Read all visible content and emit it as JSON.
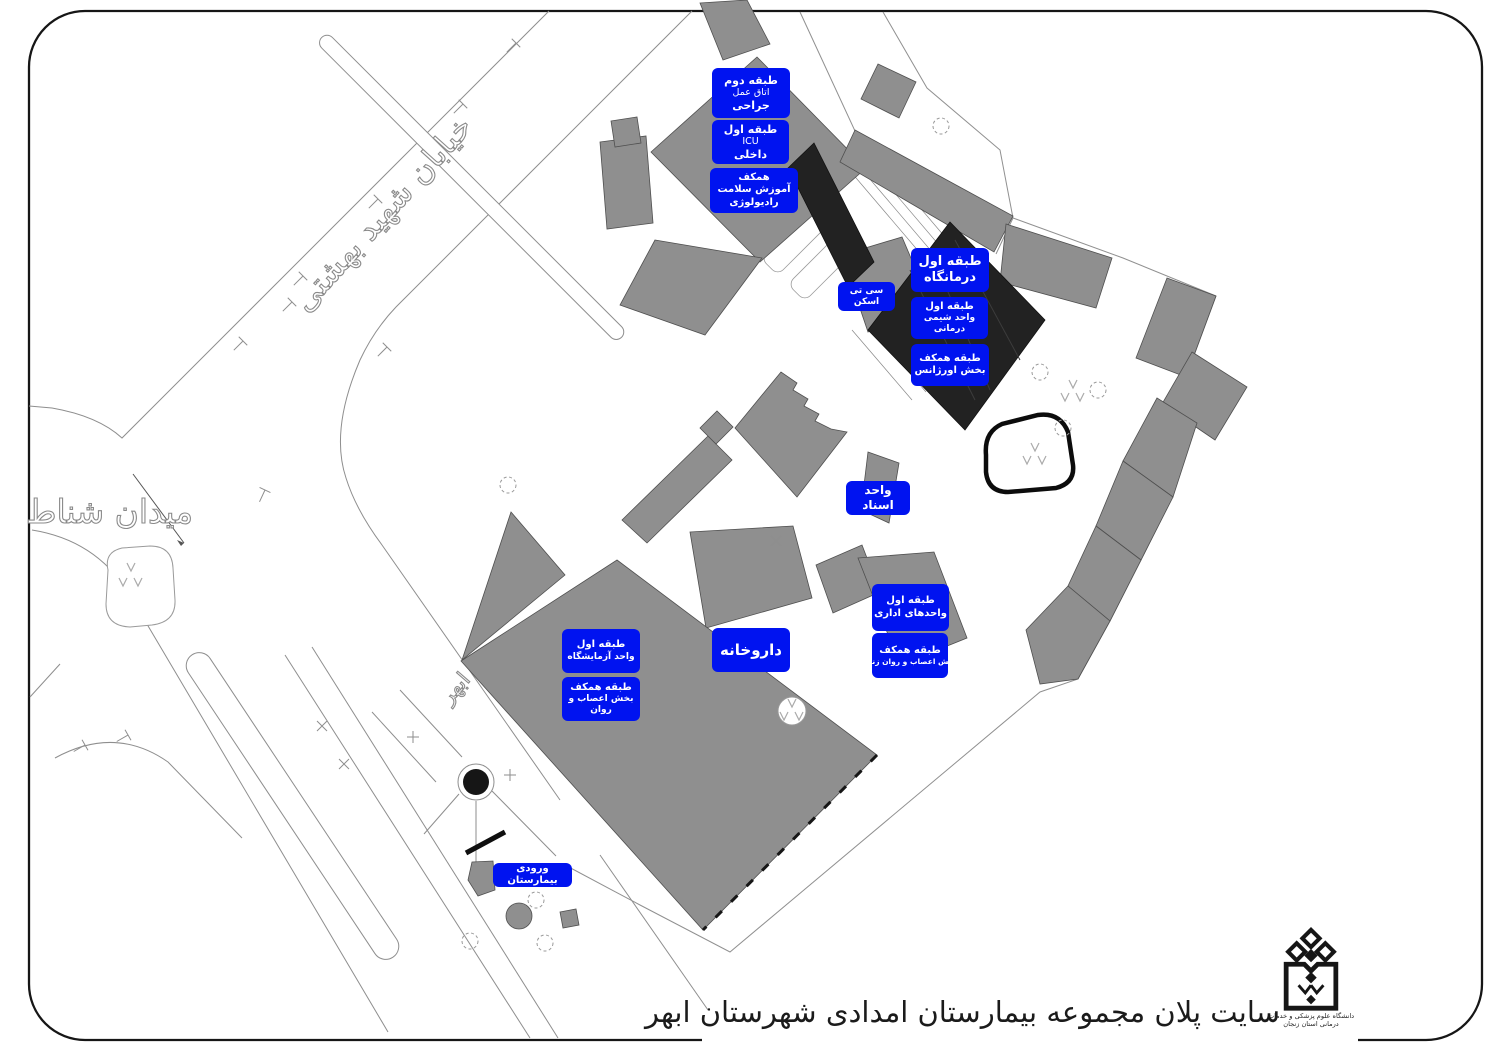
{
  "title_block": {
    "title": "سایت پلان مجموعه بیمارستان امدادی شهرستان ابهر"
  },
  "streets": {
    "boulevard": "خیابان شهید بهشتی",
    "square": "میدان شناط",
    "city": "ابهر"
  },
  "logo": {
    "caption": "دانشگاه علوم پزشکی و خدمات درمانی استان زنجان"
  },
  "map_labels": [
    {
      "id": "second-floor-surgery",
      "lines": [
        "طبقه دوم",
        "اتاق عمل",
        "جراحی"
      ]
    },
    {
      "id": "first-floor-icu",
      "lines": [
        "طبقه اول",
        "ICU",
        "داخلی"
      ]
    },
    {
      "id": "ground-floor-health-radiology",
      "lines": [
        "همکف",
        "آموزش سلامت",
        "رادیولوژی"
      ]
    },
    {
      "id": "ct-scan",
      "lines": [
        "سی تی اسکن"
      ]
    },
    {
      "id": "first-floor-clinic",
      "lines": [
        "طبقه اول",
        "درمانگاه"
      ]
    },
    {
      "id": "first-floor-chemotherapy",
      "lines": [
        "طبقه اول",
        "واحد شیمی درمانی"
      ]
    },
    {
      "id": "ground-floor-emergency",
      "lines": [
        "طبقه همکف",
        "بخش اورژانس"
      ]
    },
    {
      "id": "documents-unit",
      "lines": [
        "واحد اسناد"
      ]
    },
    {
      "id": "first-floor-admin",
      "lines": [
        "طبقه اول",
        "واحدهای اداری"
      ]
    },
    {
      "id": "ground-floor-neuro-women",
      "lines": [
        "طبقه همکف",
        "بخش اعصاب و روان زنان"
      ]
    },
    {
      "id": "first-floor-laboratory",
      "lines": [
        "طبقه اول",
        "واحد آزمایشگاه"
      ]
    },
    {
      "id": "ground-floor-neuro",
      "lines": [
        "طبقه همکف",
        "بخش اعصاب و روان"
      ]
    },
    {
      "id": "pharmacy",
      "lines": [
        "داروخانه"
      ]
    },
    {
      "id": "hospital-entrance",
      "lines": [
        "ورودی بیمارستان"
      ]
    }
  ],
  "colors": {
    "label_blue": "#0013f0",
    "building_gray": "#8f8f8f",
    "building_dark": "#222222",
    "line_gray": "#8e8e8e"
  }
}
